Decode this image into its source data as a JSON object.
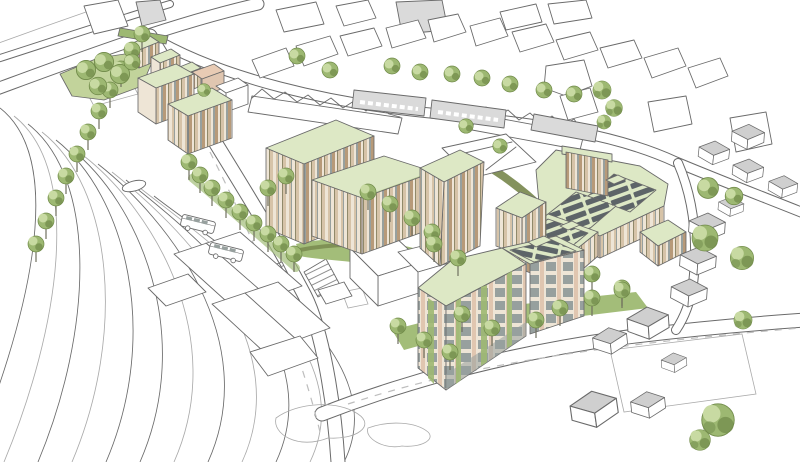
{
  "meta": {
    "canvas_width": 800,
    "canvas_height": 462,
    "style": "hand-drawn architectural aerial masterplan sketch"
  },
  "scene": {
    "description": "Aerial perspective sketch of a proposed mixed-use development: green-roofed apartment blocks with rooftop solar panels beside a railway line and station, surrounded by existing houses, roads and mature trees",
    "railway": {
      "track_count": 12
    },
    "vehicles": {
      "bus_count": 2
    },
    "landscape": {
      "park": true,
      "hedgerows": true,
      "street_tree_rows": 4,
      "crosshatch_plazas": 3,
      "pedestrian_crossings": 2
    },
    "new_buildings": [
      "terrace-row-with-green-roofs",
      "lower-apartment-blocks",
      "central-two-tier-block",
      "mid-rise-slab-block",
      "apartment-cluster-with-solar-roofs",
      "foreground-corner-block-with-green-facade"
    ],
    "context_buildings": [
      "railway-station",
      "existing-house-rows",
      "retail-gray-slabs",
      "retained-white-buildings",
      "suburban-hip-roof-houses"
    ]
  },
  "palette": {
    "paper": "#ffffff",
    "ink": "#6a6a6a",
    "ink_light": "#aaaaaa",
    "road_dash": "#bdbdbd",
    "roof_green": "#dde8c5",
    "roof_green_dark": "#b9cc93",
    "solar_dark": "#5d6468",
    "lawn": "#c2d39b",
    "verge": "#a3bd79",
    "hedge": "#79894f",
    "tree_light": "#c8daa2",
    "tree_mid": "#9db872",
    "tree_dark": "#708a49",
    "trunk": "#6f6f5f",
    "facade_tan": "#d6c3a8",
    "facade_brown": "#b79a79",
    "facade_cream": "#eee5d6",
    "facade_olive": "#90896a",
    "facade_pink": "#e0c6b0",
    "window_glass": "#97a09e",
    "context_gray": "#dadada",
    "context_roof": "#cfcfcf",
    "peach": "#e8cbb4"
  }
}
